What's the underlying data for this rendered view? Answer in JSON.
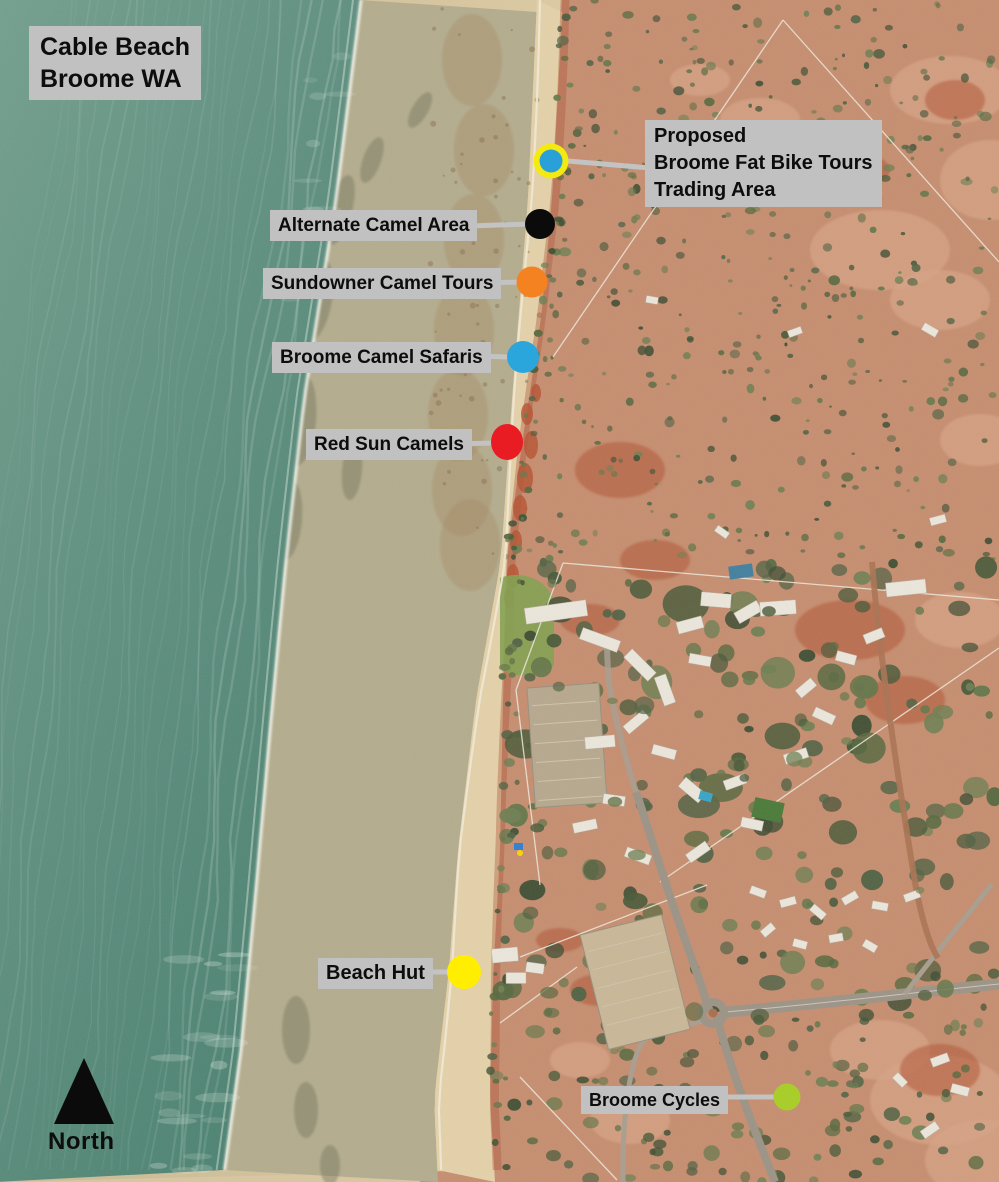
{
  "labels": {
    "title_line1": "Cable Beach",
    "title_line2": "Broome WA",
    "north": "North"
  },
  "markers": [
    {
      "name": "proposed-trading-area",
      "label_lines": [
        "Proposed",
        "Broome Fat Bike Tours",
        "Trading Area"
      ],
      "dot_color": "#2aa0d8",
      "ring_color": "#f4ea12",
      "x": 551,
      "y": 161,
      "r": 11.5,
      "ring_r": 17.5,
      "line": [
        568,
        161,
        650,
        168
      ]
    },
    {
      "name": "alternate-camel-area",
      "label": "Alternate Camel Area",
      "dot_color": "#0b0b0b",
      "x": 540,
      "y": 224,
      "r": 15,
      "line": [
        470,
        226,
        529,
        224
      ]
    },
    {
      "name": "sundowner-camel-tours",
      "label": "Sundowner Camel Tours",
      "dot_color": "#f58220",
      "x": 532,
      "y": 282,
      "r": 15.5,
      "line": [
        482,
        283,
        521,
        282
      ]
    },
    {
      "name": "broome-camel-safaris",
      "label": "Broome Camel Safaris",
      "dot_color": "#2aa6dc",
      "x": 523,
      "y": 357,
      "r": 16,
      "line": [
        477,
        356,
        511,
        357
      ]
    },
    {
      "name": "red-sun-camels",
      "label": "Red Sun Camels",
      "dot_color": "#e91c23",
      "x": 507,
      "y": 442,
      "rx": 16,
      "ry": 18,
      "line": [
        451,
        444,
        495,
        443
      ]
    },
    {
      "name": "beach-hut",
      "label": "Beach Hut",
      "dot_color": "#ffee00",
      "x": 464,
      "y": 972,
      "r": 17,
      "line": [
        424,
        972,
        451,
        972
      ]
    },
    {
      "name": "broome-cycles",
      "label": "Broome Cycles",
      "dot_color": "#a9ce2c",
      "x": 787,
      "y": 1097,
      "r": 13.5,
      "line": [
        716,
        1097,
        777,
        1097
      ]
    }
  ],
  "style": {
    "label_bg": "#c1c1c1",
    "label_text": "#0d0d0d",
    "connector": "#c3c3c3",
    "ocean": "#5f9181",
    "sand": "#d9c7a0",
    "wet_sand": "#b4ac8d",
    "dry_sand": "#e5d2a9",
    "red_dirt": "#b25536",
    "scrub_green": "#4c5c3c"
  }
}
